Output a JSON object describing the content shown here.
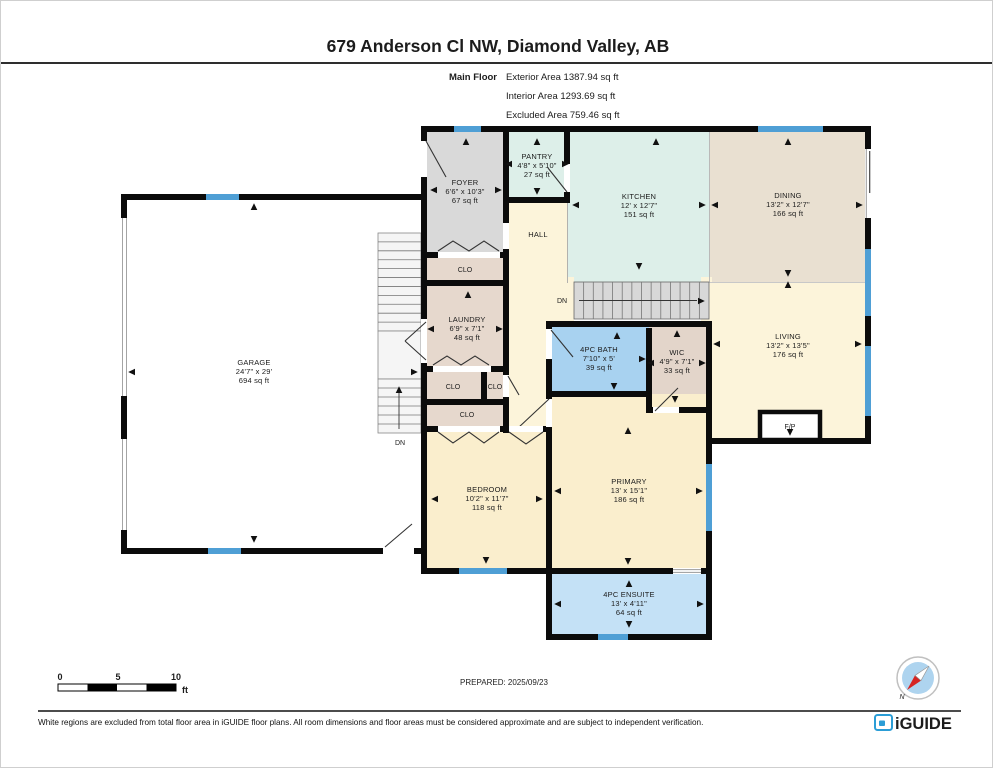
{
  "header": {
    "title": "679 Anderson Cl NW, Diamond Valley, AB",
    "floor_label": "Main Floor",
    "exterior_area": "Exterior Area 1387.94 sq ft",
    "interior_area": "Interior Area 1293.69 sq ft",
    "excluded_area": "Excluded Area 759.46 sq ft"
  },
  "rooms": {
    "foyer": {
      "name": "FOYER",
      "dims": "6'6\" x 10'3\"",
      "area": "67 sq ft"
    },
    "pantry": {
      "name": "PANTRY",
      "dims": "4'8\" x 5'10\"",
      "area": "27 sq ft"
    },
    "kitchen": {
      "name": "KITCHEN",
      "dims": "12' x 12'7\"",
      "area": "151 sq ft"
    },
    "dining": {
      "name": "DINING",
      "dims": "13'2\" x 12'7\"",
      "area": "166 sq ft"
    },
    "living": {
      "name": "LIVING",
      "dims": "13'2\" x 13'5\"",
      "area": "176 sq ft"
    },
    "laundry": {
      "name": "LAUNDRY",
      "dims": "6'9\" x 7'1\"",
      "area": "48 sq ft"
    },
    "garage": {
      "name": "GARAGE",
      "dims": "24'7\" x 29'",
      "area": "694 sq ft"
    },
    "bath": {
      "name": "4PC BATH",
      "dims": "7'10\" x 5'",
      "area": "39 sq ft"
    },
    "wic": {
      "name": "WIC",
      "dims": "4'9\" x 7'1\"",
      "area": "33 sq ft"
    },
    "bedroom": {
      "name": "BEDROOM",
      "dims": "10'2\" x 11'7\"",
      "area": "118 sq ft"
    },
    "primary": {
      "name": "PRIMARY",
      "dims": "13' x 15'1\"",
      "area": "186 sq ft"
    },
    "ensuite": {
      "name": "4PC ENSUITE",
      "dims": "13' x 4'11\"",
      "area": "64 sq ft"
    }
  },
  "labels": {
    "hall": "HALL",
    "closet": "CLO",
    "down": "DN",
    "fireplace": "F/P"
  },
  "scale_bar": {
    "ticks": [
      "0",
      "5",
      "10"
    ],
    "unit": "ft"
  },
  "compass": {
    "north": "N"
  },
  "footer": {
    "prepared": "PREPARED: 2025/09/23",
    "disclaimer": "White regions are excluded from total floor area in iGUIDE floor plans. All room dimensions and floor areas must be considered approximate and are subject to independent verification.",
    "brand": "iGUIDE"
  },
  "colors": {
    "wall": "#0b0b0b",
    "window_blue": "#4f9fd5",
    "foyer_gray": "#d9d9d9",
    "kitchen_mint": "#ddefe9",
    "dining_tan": "#e9e0d1",
    "hall_cream": "#fcf4da",
    "bedroom_cream": "#faeecd",
    "closet_tan": "#e6d8cd",
    "wic_tan": "#e3d5ca",
    "bath_blue": "#a8d2f0",
    "ensuite_blue": "#c4e1f6",
    "garage_white": "#ffffff",
    "stair_gray": "#d8d8d8",
    "brand_blue": "#2b9dd6"
  }
}
